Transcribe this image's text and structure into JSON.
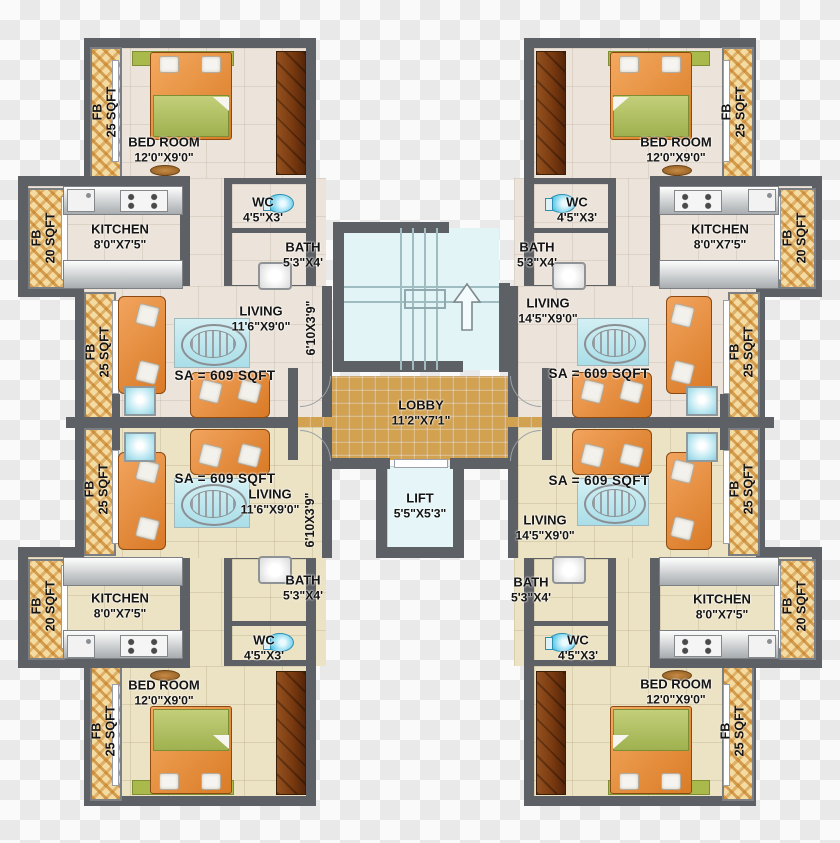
{
  "background": {
    "checker_light": "#fafafa",
    "checker_dark": "#e9e9e9"
  },
  "core": {
    "lobby": {
      "name": "LOBBY",
      "dims": "11'2\"X7'1\""
    },
    "lift": {
      "name": "LIFT",
      "dims": "5'5\"X5'3\""
    },
    "stairs": {
      "icon": "up-arrow"
    }
  },
  "units": [
    {
      "id": "top-left",
      "sa": "SA = 609 SQFT",
      "bedroom": {
        "name": "BED ROOM",
        "dims": "12'0\"X9'0\""
      },
      "kitchen": {
        "name": "KITCHEN",
        "dims": "8'0\"X7'5\""
      },
      "wc": {
        "name": "WC",
        "dims": "4'5\"X3'"
      },
      "bath": {
        "name": "BATH",
        "dims": "5'3\"X4'"
      },
      "living": {
        "name": "LIVING",
        "dims": "11'6\"X9'0\""
      },
      "passage": "6'10X3'9\"",
      "fb_bedroom": {
        "line1": "FB",
        "line2": "25 SQFT"
      },
      "fb_kitchen": {
        "line1": "FB",
        "line2": "20 SQFT"
      },
      "fb_living": {
        "line1": "FB",
        "line2": "25 SQFT"
      }
    },
    {
      "id": "top-right",
      "sa": "SA = 609 SQFT",
      "bedroom": {
        "name": "BED ROOM",
        "dims": "12'0\"X9'0\""
      },
      "kitchen": {
        "name": "KITCHEN",
        "dims": "8'0\"X7'5\""
      },
      "wc": {
        "name": "WC",
        "dims": "4'5\"X3'"
      },
      "bath": {
        "name": "BATH",
        "dims": "5'3\"X4'"
      },
      "living": {
        "name": "LIVING",
        "dims": "14'5\"X9'0\""
      },
      "fb_bedroom": {
        "line1": "FB",
        "line2": "25 SQFT"
      },
      "fb_kitchen": {
        "line1": "FB",
        "line2": "20 SQFT"
      },
      "fb_living": {
        "line1": "FB",
        "line2": "25 SQFT"
      }
    },
    {
      "id": "bottom-left",
      "sa": "SA = 609 SQFT",
      "bedroom": {
        "name": "BED ROOM",
        "dims": "12'0\"X9'0\""
      },
      "kitchen": {
        "name": "KITCHEN",
        "dims": "8'0\"X7'5\""
      },
      "wc": {
        "name": "WC",
        "dims": "4'5\"X3'"
      },
      "bath": {
        "name": "BATH",
        "dims": "5'3\"X4'"
      },
      "living": {
        "name": "LIVING",
        "dims": "11'6\"X9'0\""
      },
      "passage": "6'10X3'9\"",
      "fb_bedroom": {
        "line1": "FB",
        "line2": "25 SQFT"
      },
      "fb_kitchen": {
        "line1": "FB",
        "line2": "20 SQFT"
      },
      "fb_living": {
        "line1": "FB",
        "line2": "25 SQFT"
      }
    },
    {
      "id": "bottom-right",
      "sa": "SA = 609 SQFT",
      "bedroom": {
        "name": "BED ROOM",
        "dims": "12'0\"X9'0\""
      },
      "kitchen": {
        "name": "KITCHEN",
        "dims": "8'0\"X7'5\""
      },
      "wc": {
        "name": "WC",
        "dims": "4'5\"X3'"
      },
      "bath": {
        "name": "BATH",
        "dims": "5'3\"X4'"
      },
      "living": {
        "name": "LIVING",
        "dims": "14'5\"X9'0\""
      },
      "fb_bedroom": {
        "line1": "FB",
        "line2": "25 SQFT"
      },
      "fb_kitchen": {
        "line1": "FB",
        "line2": "20 SQFT"
      },
      "fb_living": {
        "line1": "FB",
        "line2": "25 SQFT"
      }
    }
  ]
}
